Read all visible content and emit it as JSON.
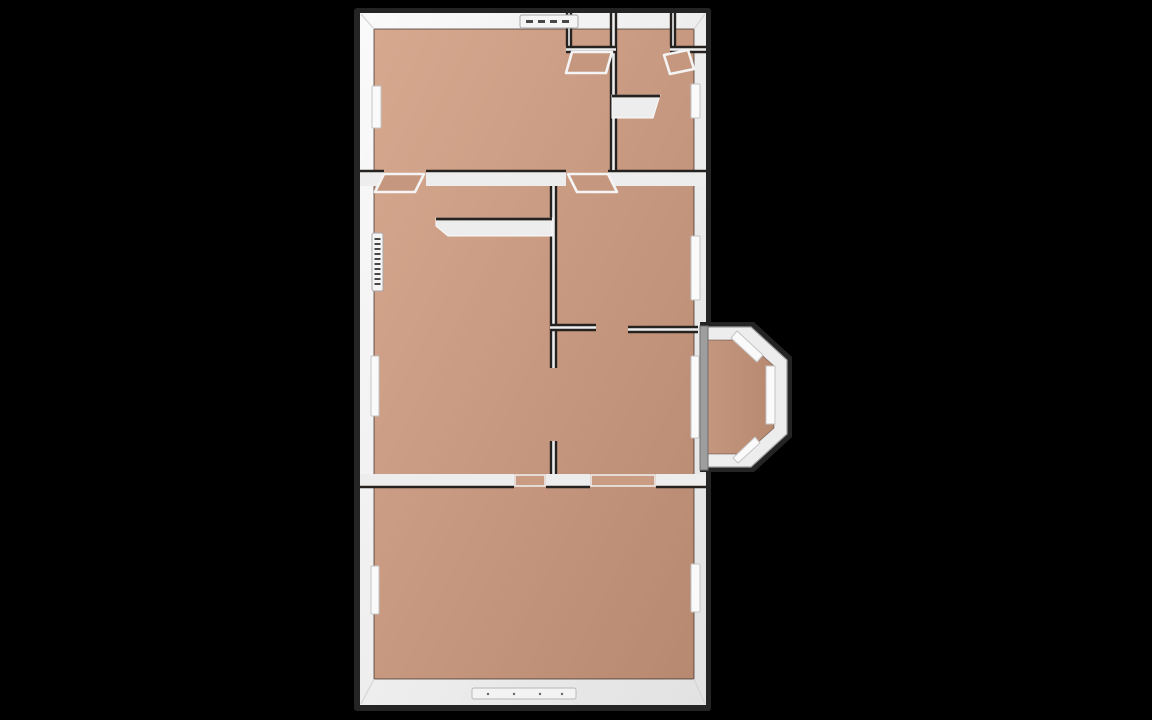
{
  "scene": {
    "description": "3D top-down rendered floor plan of an apartment on black background",
    "canvas": {
      "width": 1152,
      "height": 720
    },
    "colors": {
      "background": "#000000",
      "outline_dark": "#242424",
      "seam_dark": "#262220",
      "wall_white_light": "#fafafa",
      "wall_white": "#f0f0f0",
      "wall_white_deep": "#e2e2e2",
      "wall_fill": "#ededed",
      "outer_gray": "#9e9e9e",
      "outer_gray_edge": "#6f6f6f",
      "floor_light": "#d6a98f",
      "floor_mid": "#c6977f",
      "floor_dark": "#b78970",
      "threshold_tan": "#cb9c84",
      "window_white": "#fafafa",
      "window_edge": "#c4c4c4",
      "tick_dark": "#474747",
      "corner_seam": "#d6d6d6"
    },
    "building": {
      "rim": {
        "x": 354,
        "y": 8,
        "w": 357,
        "h": 703
      },
      "wall": {
        "x": 360,
        "y": 13,
        "w": 346,
        "h": 692
      },
      "floor": {
        "x": 374,
        "y": 29,
        "w": 320,
        "h": 650
      }
    }
  },
  "rooms": [
    {
      "name": "room-top-left",
      "x": 374,
      "y": 29,
      "w": 236,
      "h": 141
    },
    {
      "name": "closet-top-middle",
      "x": 572,
      "y": 29,
      "w": 38,
      "h": 17
    },
    {
      "name": "room-top-right",
      "x": 617,
      "y": 29,
      "w": 77,
      "h": 141
    },
    {
      "name": "closet-top-right",
      "x": 676,
      "y": 29,
      "w": 18,
      "h": 17
    },
    {
      "name": "room-middle-left",
      "x": 374,
      "y": 186,
      "w": 176,
      "h": 288
    },
    {
      "name": "room-middle-right-top",
      "x": 557,
      "y": 186,
      "w": 137,
      "h": 138
    },
    {
      "name": "room-middle-right-bottom",
      "x": 557,
      "y": 333,
      "w": 137,
      "h": 141
    },
    {
      "name": "room-bottom",
      "x": 374,
      "y": 488,
      "w": 320,
      "h": 191
    },
    {
      "name": "bay-alcove",
      "x": 708,
      "y": 340,
      "w": 66,
      "h": 114
    }
  ],
  "interior_walls": [
    {
      "name": "wall-top-divider-left",
      "x": 360,
      "y": 170,
      "w": 24,
      "h": 16,
      "edges": [
        "top"
      ]
    },
    {
      "name": "wall-top-divider-center",
      "x": 426,
      "y": 170,
      "w": 140,
      "h": 16,
      "edges": [
        "top"
      ]
    },
    {
      "name": "wall-top-divider-right",
      "x": 608,
      "y": 170,
      "w": 98,
      "h": 16,
      "edges": [
        "top"
      ]
    },
    {
      "name": "wall-topband-vertical",
      "x": 610,
      "y": 13,
      "w": 7,
      "h": 157,
      "edges": [
        "left",
        "right"
      ]
    },
    {
      "name": "wall-closet-left-side",
      "x": 566,
      "y": 13,
      "w": 6,
      "h": 33,
      "edges": [
        "left",
        "right"
      ]
    },
    {
      "name": "wall-closet-left-front",
      "x": 566,
      "y": 46,
      "w": 50,
      "h": 7,
      "edges": [
        "top",
        "bottom"
      ]
    },
    {
      "name": "wall-closet-right-side",
      "x": 670,
      "y": 13,
      "w": 6,
      "h": 33,
      "edges": [
        "left",
        "right"
      ]
    },
    {
      "name": "wall-closet-right-front",
      "x": 670,
      "y": 46,
      "w": 36,
      "h": 7,
      "edges": [
        "top",
        "bottom"
      ]
    },
    {
      "name": "wall-middle-vertical",
      "x": 550,
      "y": 186,
      "w": 7,
      "h": 182,
      "edges": [
        "left",
        "right"
      ]
    },
    {
      "name": "wall-middle-vertical-stub",
      "x": 550,
      "y": 441,
      "w": 7,
      "h": 33,
      "edges": [
        "left",
        "right"
      ]
    },
    {
      "name": "wall-middle-horizontal-stub",
      "x": 550,
      "y": 324,
      "w": 46,
      "h": 7,
      "edges": [
        "top",
        "bottom"
      ]
    },
    {
      "name": "wall-middle-horizontal",
      "x": 628,
      "y": 326,
      "w": 70,
      "h": 7,
      "edges": [
        "top",
        "bottom"
      ]
    },
    {
      "name": "wall-bottom-divider-left",
      "x": 360,
      "y": 474,
      "w": 154,
      "h": 14,
      "edges": [
        "bottom"
      ]
    },
    {
      "name": "wall-bottom-divider-center",
      "x": 546,
      "y": 474,
      "w": 44,
      "h": 14,
      "edges": [
        "bottom"
      ]
    },
    {
      "name": "wall-bottom-divider-right",
      "x": 656,
      "y": 474,
      "w": 50,
      "h": 14,
      "edges": [
        "bottom"
      ]
    }
  ],
  "furniture": [
    {
      "name": "counter-half-wall",
      "points": "436,218 552,218 552,236 448,236 436,226",
      "top_edge": [
        436,
        219,
        552,
        219
      ]
    },
    {
      "name": "shelf-top-right-room",
      "points": "612,95 660,95 653,118 612,118",
      "top_edge": [
        612,
        96,
        660,
        96
      ]
    }
  ],
  "doors": [
    {
      "name": "door-top-left-room",
      "points": "384,174 424,174 415,192 375,192"
    },
    {
      "name": "door-middle-bedroom",
      "points": "568,174 608,174 617,192 577,192"
    },
    {
      "name": "door-closet-left",
      "points": "572,52 612,52 606,73 566,73"
    },
    {
      "name": "door-closet-right",
      "points": "688,50 664,55 670,74 694,69"
    }
  ],
  "floor_thresholds": [
    {
      "name": "doorway-bottom-left",
      "x": 515,
      "y": 475,
      "w": 30,
      "h": 11
    },
    {
      "name": "doorway-bottom-right",
      "x": 591,
      "y": 475,
      "w": 64,
      "h": 11
    }
  ],
  "windows": [
    {
      "name": "window-left-top",
      "x": 372,
      "y": 86,
      "w": 9,
      "h": 42
    },
    {
      "name": "window-right-top",
      "x": 691,
      "y": 84,
      "w": 9,
      "h": 34
    },
    {
      "name": "window-left-middle",
      "x": 371,
      "y": 356,
      "w": 8,
      "h": 60
    },
    {
      "name": "window-right-middle",
      "x": 691,
      "y": 236,
      "w": 9,
      "h": 64
    },
    {
      "name": "window-bay-inner",
      "x": 691,
      "y": 356,
      "w": 8,
      "h": 82
    },
    {
      "name": "window-left-bottom",
      "x": 371,
      "y": 566,
      "w": 8,
      "h": 48
    },
    {
      "name": "window-right-bottom",
      "x": 691,
      "y": 564,
      "w": 9,
      "h": 48
    }
  ],
  "radiators": [
    {
      "name": "radiator-top-wall",
      "x": 520,
      "y": 15,
      "w": 58,
      "h": 13,
      "orientation": "horizontal"
    },
    {
      "name": "radiator-left-wall",
      "x": 372,
      "y": 233,
      "w": 11,
      "h": 58,
      "orientation": "vertical"
    }
  ],
  "door_track_bottom": {
    "name": "sliding-door-track",
    "x": 472,
    "y": 688,
    "w": 104,
    "h": 11,
    "dots_y": 694,
    "dots_x": [
      488,
      514,
      540,
      562
    ]
  },
  "bay_window": {
    "outer_points": "700,322 754,322 792,357 792,437 754,472 700,472",
    "wall_points": "703,327 751,327 787,360 787,434 751,467 703,467",
    "floor_points": "703,340 745,340 774,366 774,428 745,454 703,454",
    "windows": [
      {
        "name": "bay-window-top-diagonal",
        "points": "737,331 763,355 757,362 731,338"
      },
      {
        "name": "bay-window-right",
        "points": "766,366 775,366 775,424 766,424"
      },
      {
        "name": "bay-window-bottom-diagonal",
        "points": "733,458 755,437 760,443 738,463"
      }
    ],
    "gray_strip": {
      "x": 700,
      "y": 326,
      "w": 8,
      "h": 144
    }
  },
  "corner_seams": [
    [
      374,
      29,
      361,
      14
    ],
    [
      694,
      29,
      705,
      14
    ],
    [
      374,
      679,
      361,
      704
    ],
    [
      694,
      679,
      705,
      704
    ]
  ]
}
